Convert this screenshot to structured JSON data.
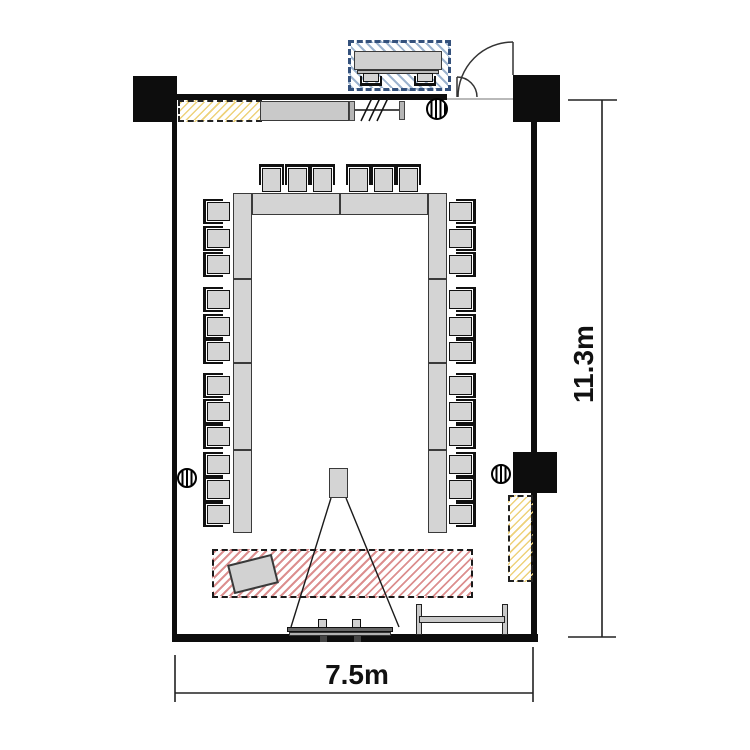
{
  "labels": {
    "room_height": "11.3m",
    "room_width": "7.5m"
  },
  "colors": {
    "wall": "#0d0d0d",
    "furniture_fill": "#d4d4d4",
    "furniture_border": "#3a3a3a",
    "red_hatch": "#dc8f8f",
    "yellow_hatch": "#eed27a",
    "blue_hatch": "#9db4cf",
    "blue_border": "#34517c",
    "dimension_text": "#111111"
  },
  "icons": [
    "door-swing-icon",
    "partition-slash-icon",
    "ceiling-column-circle-icon",
    "projector-icon",
    "projection-beam-icon",
    "screen-icon",
    "lectern-icon"
  ],
  "furniture": {
    "table_segments": [
      {
        "x": 233,
        "y": 193,
        "w": 19,
        "h": 86
      },
      {
        "x": 233,
        "y": 279,
        "w": 19,
        "h": 84
      },
      {
        "x": 233,
        "y": 363,
        "w": 19,
        "h": 87
      },
      {
        "x": 233,
        "y": 450,
        "w": 19,
        "h": 83
      },
      {
        "x": 428,
        "y": 193,
        "w": 19,
        "h": 86
      },
      {
        "x": 428,
        "y": 279,
        "w": 19,
        "h": 84
      },
      {
        "x": 428,
        "y": 363,
        "w": 19,
        "h": 87
      },
      {
        "x": 428,
        "y": 450,
        "w": 19,
        "h": 83
      },
      {
        "x": 252,
        "y": 193,
        "w": 88,
        "h": 22
      },
      {
        "x": 340,
        "y": 193,
        "w": 88,
        "h": 22
      }
    ],
    "chairs": {
      "top_row": {
        "dir": "up",
        "y": 164,
        "w": 25,
        "h": 29,
        "xs": [
          259,
          285,
          310,
          346,
          371,
          396
        ]
      },
      "left_col": {
        "dir": "left",
        "x": 203,
        "w": 28,
        "h": 25,
        "ys": [
          199,
          226,
          252,
          287,
          314,
          339,
          373,
          399,
          424,
          452,
          477,
          502
        ]
      },
      "right_col": {
        "dir": "right",
        "x": 448,
        "w": 28,
        "h": 25,
        "ys": [
          199,
          226,
          252,
          287,
          314,
          339,
          373,
          399,
          424,
          452,
          477,
          502
        ]
      },
      "reception": {
        "dir": "down",
        "y": 72,
        "w": 22,
        "h": 14,
        "xs": [
          360,
          414
        ]
      }
    },
    "counts": {
      "u_shape_chairs": 30,
      "reception_chairs": 2
    }
  }
}
